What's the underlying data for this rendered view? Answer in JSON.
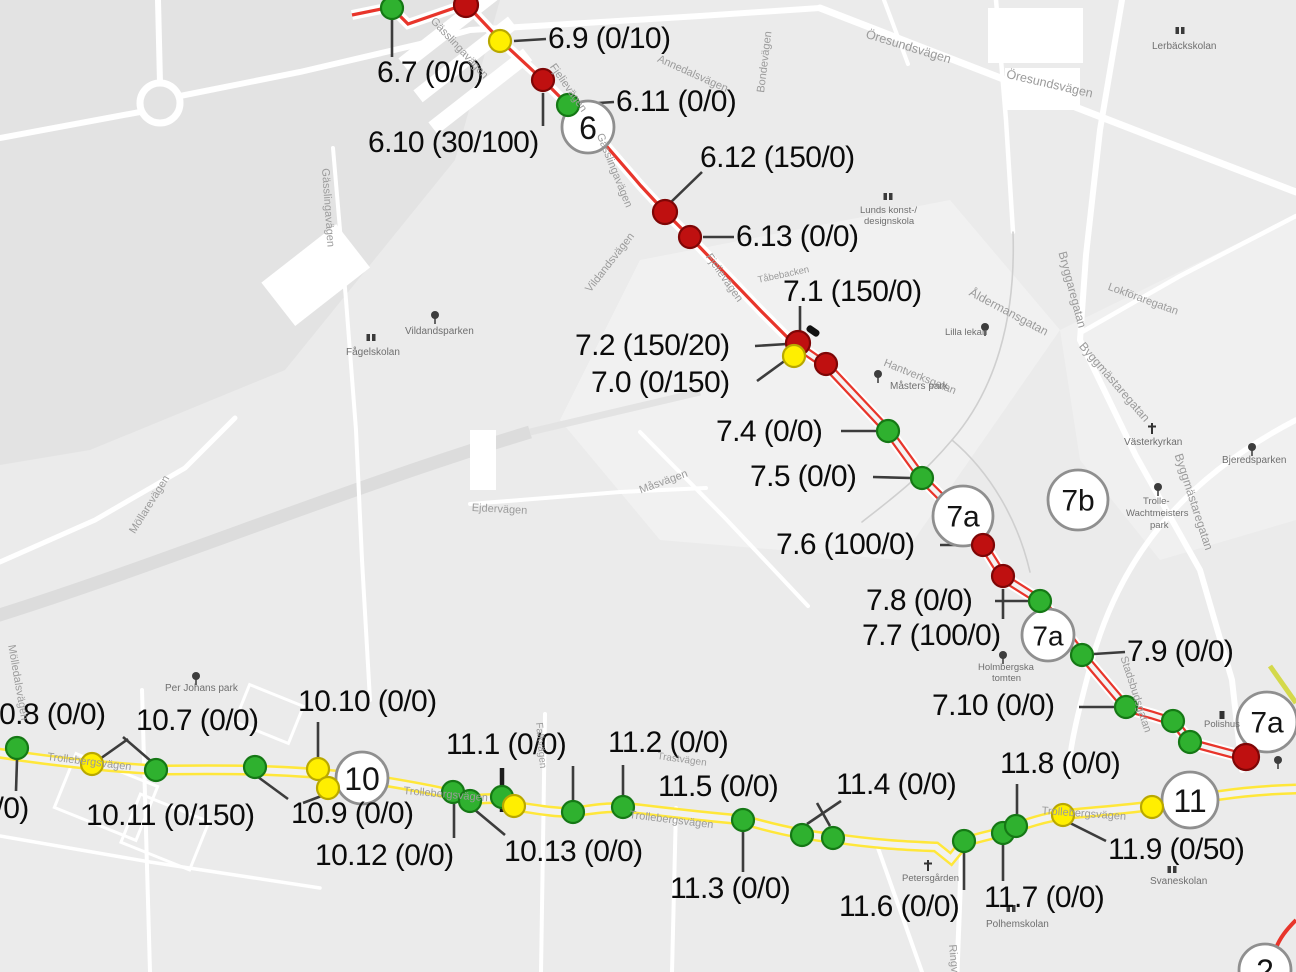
{
  "map": {
    "colors": {
      "background": "#ebebeb",
      "route_red": "#e8352b",
      "route_yellow": "#ffe73a",
      "route_olive": "#d4d94b",
      "dot_green": "#2fb12f",
      "dot_green_edge": "#157815",
      "dot_yellow": "#ffef00",
      "dot_yellow_edge": "#b9a800",
      "dot_red": "#bf1010",
      "dot_red_edge": "#7e0606",
      "leader": "#3c3c3c",
      "badge_border": "#8f8f8f",
      "label_text": "#0b0b0b",
      "street_text": "#9b9b9b",
      "poi_text": "#6f6f6f"
    },
    "badges": [
      {
        "text": "6",
        "x": 588,
        "y": 127,
        "r": 26,
        "fs": 32
      },
      {
        "text": "7a",
        "x": 963,
        "y": 516,
        "r": 30,
        "fs": 30
      },
      {
        "text": "7b",
        "x": 1078,
        "y": 500,
        "r": 30,
        "fs": 30
      },
      {
        "text": "7a",
        "x": 1048,
        "y": 635,
        "r": 26,
        "fs": 28
      },
      {
        "text": "7a",
        "x": 1267,
        "y": 722,
        "r": 30,
        "fs": 30
      },
      {
        "text": "10",
        "x": 362,
        "y": 778,
        "r": 26,
        "fs": 32
      },
      {
        "text": "11",
        "x": 1190,
        "y": 800,
        "r": 28,
        "fs": 32
      },
      {
        "text": "2",
        "x": 1265,
        "y": 970,
        "r": 26,
        "fs": 32
      }
    ],
    "station_labels": [
      {
        "text": "6.9 (0/10)",
        "x": 548,
        "y": 24
      },
      {
        "text": "6.7 (0/0)",
        "x": 377,
        "y": 58
      },
      {
        "text": "6.11 (0/0)",
        "x": 616,
        "y": 87
      },
      {
        "text": "6.10 (30/100)",
        "x": 368,
        "y": 128
      },
      {
        "text": "6.12 (150/0)",
        "x": 700,
        "y": 143
      },
      {
        "text": "6.13 (0/0)",
        "x": 736,
        "y": 222
      },
      {
        "text": "7.1 (150/0)",
        "x": 783,
        "y": 277
      },
      {
        "text": "7.2 (150/20)",
        "x": 575,
        "y": 331
      },
      {
        "text": "7.0 (0/150)",
        "x": 591,
        "y": 368
      },
      {
        "text": "7.4 (0/0)",
        "x": 716,
        "y": 417
      },
      {
        "text": "7.5 (0/0)",
        "x": 750,
        "y": 462
      },
      {
        "text": "7.6 (100/0)",
        "x": 776,
        "y": 530
      },
      {
        "text": "7.8 (0/0)",
        "x": 866,
        "y": 586
      },
      {
        "text": "7.7 (100/0)",
        "x": 862,
        "y": 621
      },
      {
        "text": "7.9 (0/0)",
        "x": 1127,
        "y": 637
      },
      {
        "text": "7.10 (0/0)",
        "x": 932,
        "y": 691
      },
      {
        "text": "10.8 (0/0)",
        "x": -17,
        "y": 700
      },
      {
        "text": "10.7 (0/0)",
        "x": 136,
        "y": 706
      },
      {
        "text": "10.10 (0/0)",
        "x": 298,
        "y": 687
      },
      {
        "text": "11.1 (0/0)",
        "x": 446,
        "y": 730
      },
      {
        "text": "11.2 (0/0)",
        "x": 608,
        "y": 728
      },
      {
        "text": "(0/0)",
        "x": -30,
        "y": 794
      },
      {
        "text": "10.11 (0/150)",
        "x": 86,
        "y": 801
      },
      {
        "text": "10.9 (0/0)",
        "x": 291,
        "y": 799
      },
      {
        "text": "11.5 (0/0)",
        "x": 658,
        "y": 772
      },
      {
        "text": "11.4 (0/0)",
        "x": 836,
        "y": 770
      },
      {
        "text": "11.8 (0/0)",
        "x": 1000,
        "y": 749
      },
      {
        "text": "10.12 (0/0)",
        "x": 315,
        "y": 841
      },
      {
        "text": "10.13 (0/0)",
        "x": 504,
        "y": 837
      },
      {
        "text": "11.3 (0/0)",
        "x": 670,
        "y": 874
      },
      {
        "text": "11.6 (0/0)",
        "x": 839,
        "y": 892
      },
      {
        "text": "11.7 (0/0)",
        "x": 984,
        "y": 883
      },
      {
        "text": "11.9 (0/50)",
        "x": 1108,
        "y": 835
      }
    ],
    "stations": [
      {
        "x": 392,
        "y": 8,
        "c": "g",
        "r": 11
      },
      {
        "x": 466,
        "y": 5,
        "c": "r",
        "r": 12
      },
      {
        "x": 500,
        "y": 41,
        "c": "y",
        "r": 11
      },
      {
        "x": 543,
        "y": 80,
        "c": "r",
        "r": 11
      },
      {
        "x": 568,
        "y": 105,
        "c": "g",
        "r": 11
      },
      {
        "x": 665,
        "y": 212,
        "c": "r",
        "r": 12
      },
      {
        "x": 690,
        "y": 237,
        "c": "r",
        "r": 11
      },
      {
        "x": 798,
        "y": 343,
        "c": "r",
        "r": 12
      },
      {
        "x": 794,
        "y": 356,
        "c": "y",
        "r": 11
      },
      {
        "x": 826,
        "y": 364,
        "c": "r",
        "r": 11
      },
      {
        "x": 888,
        "y": 431,
        "c": "g",
        "r": 11
      },
      {
        "x": 922,
        "y": 478,
        "c": "g",
        "r": 11
      },
      {
        "x": 983,
        "y": 545,
        "c": "r",
        "r": 11
      },
      {
        "x": 1003,
        "y": 576,
        "c": "r",
        "r": 11
      },
      {
        "x": 1040,
        "y": 601,
        "c": "g",
        "r": 11
      },
      {
        "x": 1082,
        "y": 655,
        "c": "g",
        "r": 11
      },
      {
        "x": 1126,
        "y": 707,
        "c": "g",
        "r": 11
      },
      {
        "x": 1173,
        "y": 721,
        "c": "g",
        "r": 11
      },
      {
        "x": 1190,
        "y": 742,
        "c": "g",
        "r": 11
      },
      {
        "x": 1246,
        "y": 757,
        "c": "r",
        "r": 13
      },
      {
        "x": 17,
        "y": 748,
        "c": "g",
        "r": 11
      },
      {
        "x": 92,
        "y": 764,
        "c": "y",
        "r": 11
      },
      {
        "x": 156,
        "y": 770,
        "c": "g",
        "r": 11
      },
      {
        "x": 255,
        "y": 767,
        "c": "g",
        "r": 11
      },
      {
        "x": 318,
        "y": 769,
        "c": "y",
        "r": 11
      },
      {
        "x": 328,
        "y": 788,
        "c": "y",
        "r": 11
      },
      {
        "x": 453,
        "y": 792,
        "c": "g",
        "r": 11
      },
      {
        "x": 470,
        "y": 801,
        "c": "g",
        "r": 11
      },
      {
        "x": 502,
        "y": 797,
        "c": "g",
        "r": 11
      },
      {
        "x": 514,
        "y": 806,
        "c": "y",
        "r": 11
      },
      {
        "x": 573,
        "y": 812,
        "c": "g",
        "r": 11
      },
      {
        "x": 623,
        "y": 807,
        "c": "g",
        "r": 11
      },
      {
        "x": 743,
        "y": 820,
        "c": "g",
        "r": 11
      },
      {
        "x": 802,
        "y": 835,
        "c": "g",
        "r": 11
      },
      {
        "x": 833,
        "y": 838,
        "c": "g",
        "r": 11
      },
      {
        "x": 964,
        "y": 841,
        "c": "g",
        "r": 11
      },
      {
        "x": 1003,
        "y": 833,
        "c": "g",
        "r": 11
      },
      {
        "x": 1016,
        "y": 826,
        "c": "g",
        "r": 11
      },
      {
        "x": 1063,
        "y": 815,
        "c": "y",
        "r": 11
      },
      {
        "x": 1152,
        "y": 807,
        "c": "y",
        "r": 11
      }
    ],
    "leaders": [
      [
        392,
        18,
        392,
        57
      ],
      [
        514,
        41,
        546,
        39
      ],
      [
        543,
        93,
        543,
        126
      ],
      [
        582,
        104,
        614,
        102
      ],
      [
        668,
        205,
        702,
        172
      ],
      [
        703,
        237,
        734,
        237
      ],
      [
        800,
        306,
        800,
        337
      ],
      [
        755,
        346,
        787,
        344
      ],
      [
        757,
        381,
        790,
        357
      ],
      [
        841,
        431,
        876,
        431
      ],
      [
        873,
        477,
        910,
        478
      ],
      [
        940,
        545,
        971,
        545
      ],
      [
        995,
        601,
        1028,
        601
      ],
      [
        1003,
        589,
        1003,
        619
      ],
      [
        1094,
        654,
        1125,
        652
      ],
      [
        1079,
        707,
        1114,
        707
      ],
      [
        123,
        737,
        152,
        762
      ],
      [
        128,
        739,
        97,
        761
      ],
      [
        17,
        760,
        16,
        791
      ],
      [
        258,
        777,
        288,
        799
      ],
      [
        318,
        722,
        318,
        757
      ],
      [
        324,
        795,
        303,
        803
      ],
      [
        454,
        804,
        454,
        838
      ],
      [
        475,
        810,
        505,
        835
      ],
      [
        573,
        766,
        573,
        800
      ],
      [
        623,
        765,
        623,
        795
      ],
      [
        817,
        803,
        830,
        826
      ],
      [
        841,
        801,
        807,
        824
      ],
      [
        743,
        832,
        743,
        872
      ],
      [
        964,
        853,
        964,
        890
      ],
      [
        1003,
        845,
        1003,
        881
      ],
      [
        1017,
        784,
        1017,
        814
      ],
      [
        1070,
        823,
        1106,
        841
      ]
    ],
    "background_labels": [
      {
        "text": "Öresundsvägen",
        "x": 868,
        "y": 28,
        "rot": 17,
        "fs": 12.5,
        "poi": false
      },
      {
        "text": "Öresundsvägen",
        "x": 1008,
        "y": 68,
        "rot": 13,
        "fs": 12.5,
        "poi": false
      },
      {
        "text": "Lerbäckskolan",
        "x": 1152,
        "y": 42,
        "rot": 0,
        "fs": 10,
        "poi": true
      },
      {
        "text": "Annedalsvägen",
        "x": 660,
        "y": 54,
        "rot": 24,
        "fs": 11,
        "poi": false
      },
      {
        "text": "Bondevägen",
        "x": 756,
        "y": 92,
        "rot": -83,
        "fs": 11,
        "poi": false
      },
      {
        "text": "Gässlingavägen",
        "x": 436,
        "y": 16,
        "rot": 47,
        "fs": 11,
        "poi": false
      },
      {
        "text": "Gässlingavägen",
        "x": 330,
        "y": 168,
        "rot": 86,
        "fs": 11,
        "poi": false
      },
      {
        "text": "Gässlingavägen",
        "x": 604,
        "y": 132,
        "rot": 68,
        "fs": 11,
        "poi": false
      },
      {
        "text": "Fjelievägen",
        "x": 556,
        "y": 62,
        "rot": 55,
        "fs": 11,
        "poi": false
      },
      {
        "text": "Fjelievägen",
        "x": 712,
        "y": 252,
        "rot": 55,
        "fs": 11,
        "poi": false
      },
      {
        "text": "Tåbebacken",
        "x": 757,
        "y": 276,
        "rot": -12,
        "fs": 9.5,
        "poi": false
      },
      {
        "text": "Vildandsvägen",
        "x": 584,
        "y": 288,
        "rot": -52,
        "fs": 11,
        "poi": false
      },
      {
        "text": "Vildandsparken",
        "x": 405,
        "y": 327,
        "rot": 0,
        "fs": 10,
        "poi": true
      },
      {
        "text": "Fågelskolan",
        "x": 346,
        "y": 348,
        "rot": 0,
        "fs": 10,
        "poi": true
      },
      {
        "text": "Måsvägen",
        "x": 638,
        "y": 486,
        "rot": -20,
        "fs": 11,
        "poi": false
      },
      {
        "text": "Ejdervägen",
        "x": 472,
        "y": 503,
        "rot": 3,
        "fs": 11,
        "poi": false
      },
      {
        "text": "Möllarevägen",
        "x": 128,
        "y": 530,
        "rot": -58,
        "fs": 11,
        "poi": false
      },
      {
        "text": "Mölledalsvägen",
        "x": 16,
        "y": 644,
        "rot": 80,
        "fs": 11,
        "poi": false
      },
      {
        "text": "Per Johans park",
        "x": 165,
        "y": 684,
        "rot": 0,
        "fs": 10,
        "poi": true
      },
      {
        "text": "Trollebergsvägen",
        "x": 48,
        "y": 752,
        "rot": 7,
        "fs": 11,
        "poi": false
      },
      {
        "text": "Trollebergsvägen",
        "x": 404,
        "y": 786,
        "rot": 5,
        "fs": 11,
        "poi": false
      },
      {
        "text": "Trollebergsvägen",
        "x": 630,
        "y": 810,
        "rot": 7,
        "fs": 11,
        "poi": false
      },
      {
        "text": "Trollebergsvägen",
        "x": 1042,
        "y": 806,
        "rot": 4,
        "fs": 11,
        "poi": false
      },
      {
        "text": "Trastvägen",
        "x": 658,
        "y": 752,
        "rot": 8,
        "fs": 10,
        "poi": false
      },
      {
        "text": "Falkvägen",
        "x": 543,
        "y": 722,
        "rot": 85,
        "fs": 10,
        "poi": false
      },
      {
        "text": "Lunds konst-/",
        "x": 860,
        "y": 206,
        "rot": 0,
        "fs": 9.5,
        "poi": true
      },
      {
        "text": "designskola",
        "x": 864,
        "y": 217,
        "rot": 0,
        "fs": 9.5,
        "poi": true
      },
      {
        "text": "Lilla lekan",
        "x": 945,
        "y": 328,
        "rot": 0,
        "fs": 9.5,
        "poi": true
      },
      {
        "text": "Hantverksgatan",
        "x": 886,
        "y": 358,
        "rot": 22,
        "fs": 11,
        "poi": false
      },
      {
        "text": "Måsters park",
        "x": 890,
        "y": 382,
        "rot": 0,
        "fs": 10,
        "poi": true
      },
      {
        "text": "Bryggaregatan",
        "x": 1068,
        "y": 250,
        "rot": 75,
        "fs": 12,
        "poi": false
      },
      {
        "text": "Åldermansgatan",
        "x": 973,
        "y": 286,
        "rot": 28,
        "fs": 12,
        "poi": false
      },
      {
        "text": "Lokföraregatan",
        "x": 1110,
        "y": 282,
        "rot": 20,
        "fs": 11,
        "poi": false
      },
      {
        "text": "Byggmästaregatan",
        "x": 1086,
        "y": 340,
        "rot": 49,
        "fs": 12,
        "poi": false
      },
      {
        "text": "Byggmästaregatan",
        "x": 1184,
        "y": 452,
        "rot": 72,
        "fs": 12,
        "poi": false
      },
      {
        "text": "Västerkyrkan",
        "x": 1124,
        "y": 438,
        "rot": 0,
        "fs": 10,
        "poi": true
      },
      {
        "text": "Bjeredsparken",
        "x": 1222,
        "y": 456,
        "rot": 0,
        "fs": 10,
        "poi": true
      },
      {
        "text": "Trolle-",
        "x": 1143,
        "y": 497,
        "rot": 0,
        "fs": 9.5,
        "poi": true
      },
      {
        "text": "Wachtmeisters",
        "x": 1126,
        "y": 509,
        "rot": 0,
        "fs": 9.5,
        "poi": true
      },
      {
        "text": "park",
        "x": 1150,
        "y": 521,
        "rot": 0,
        "fs": 9.5,
        "poi": true
      },
      {
        "text": "Stadsbudsgatan",
        "x": 1128,
        "y": 655,
        "rot": 72,
        "fs": 11,
        "poi": false
      },
      {
        "text": "Holmbergska",
        "x": 978,
        "y": 663,
        "rot": 0,
        "fs": 9.5,
        "poi": true
      },
      {
        "text": "tomten",
        "x": 992,
        "y": 674,
        "rot": 0,
        "fs": 9.5,
        "poi": true
      },
      {
        "text": "Polishus",
        "x": 1204,
        "y": 720,
        "rot": 0,
        "fs": 9.5,
        "poi": true
      },
      {
        "text": "Petersgården",
        "x": 902,
        "y": 874,
        "rot": 0,
        "fs": 9.5,
        "poi": true
      },
      {
        "text": "Polhemskolan",
        "x": 986,
        "y": 920,
        "rot": 0,
        "fs": 10,
        "poi": true
      },
      {
        "text": "Svaneskolan",
        "x": 1150,
        "y": 877,
        "rot": 0,
        "fs": 10,
        "poi": true
      },
      {
        "text": "Ringvägen",
        "x": 957,
        "y": 944,
        "rot": 85,
        "fs": 11,
        "poi": false
      }
    ],
    "symbols": [
      {
        "type": "tree",
        "x": 435,
        "y": 316
      },
      {
        "type": "tree",
        "x": 196,
        "y": 677
      },
      {
        "type": "tree",
        "x": 878,
        "y": 375
      },
      {
        "type": "tree",
        "x": 1252,
        "y": 448
      },
      {
        "type": "tree",
        "x": 1158,
        "y": 488
      },
      {
        "type": "tree",
        "x": 1003,
        "y": 656
      },
      {
        "type": "tree",
        "x": 1278,
        "y": 761
      },
      {
        "type": "tree",
        "x": 985,
        "y": 328
      },
      {
        "type": "church",
        "x": 1152,
        "y": 429
      },
      {
        "type": "church",
        "x": 928,
        "y": 866
      },
      {
        "type": "school",
        "x": 1180,
        "y": 31
      },
      {
        "type": "school",
        "x": 888,
        "y": 197
      },
      {
        "type": "school",
        "x": 371,
        "y": 338
      },
      {
        "type": "school",
        "x": 1011,
        "y": 909
      },
      {
        "type": "school",
        "x": 1172,
        "y": 870
      },
      {
        "type": "police",
        "x": 1222,
        "y": 715
      },
      {
        "type": "tick",
        "x": 502,
        "y": 790
      },
      {
        "type": "blob",
        "x": 813,
        "y": 331
      }
    ]
  }
}
